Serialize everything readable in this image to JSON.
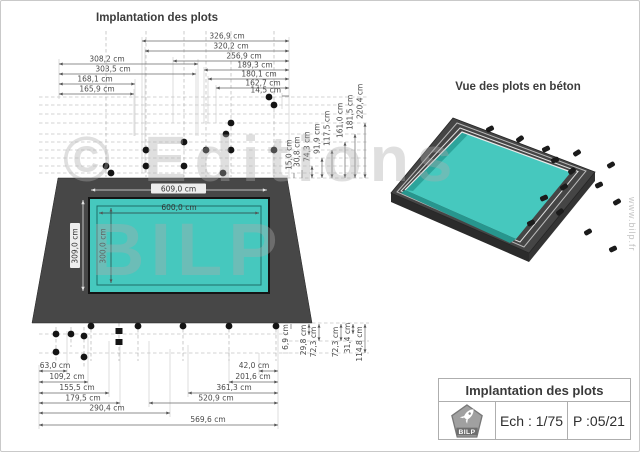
{
  "page": {
    "watermark_line1": "© Editions",
    "watermark_line2": "BILP",
    "website": "www.bilp.fr"
  },
  "plan": {
    "title": "Implantation des plots",
    "top_dims": [
      "326,9 cm",
      "320,2 cm",
      "256,9 cm",
      "189,3 cm",
      "180,1 cm",
      "162,7 cm",
      "14,5 cm"
    ],
    "left_dims": [
      "308,2 cm",
      "303,5 cm",
      "168,1 cm",
      "165,9 cm"
    ],
    "right_dims": [
      "15,0 cm",
      "30,8 cm",
      "74,3 cm",
      "91,9 cm",
      "117,5 cm",
      "161,0 cm",
      "181,5 cm",
      "220,4 cm"
    ],
    "pool": {
      "outer_width": "609,0 cm",
      "inner_width": "600,0 cm",
      "outer_length": "309,0 cm",
      "inner_length": "300,0 cm"
    },
    "bottom_left_dims": [
      "63,0 cm",
      "109,2 cm",
      "155,5 cm",
      "179,5 cm",
      "290,4 cm"
    ],
    "bottom_right_dims": [
      "42,0 cm",
      "201,6 cm",
      "361,3 cm",
      "520,9 cm"
    ],
    "bottom_total_dim": "569,6 cm",
    "bottom_vertical_dims": [
      "6,9 cm",
      "29,8 cm",
      "72,3 cm",
      "72,3 cm",
      "31,4 cm",
      "114,8 cm"
    ]
  },
  "perspective": {
    "title": "Vue des plots en béton"
  },
  "title_block": {
    "title": "Implantation des plots",
    "scale": "Ech : 1/75",
    "page": "P :05/21",
    "logo_text": "BILP"
  },
  "colors": {
    "pool": "#46c8be",
    "deck": "#474747",
    "plot": "#141414",
    "watermark": "#bdbdbd"
  }
}
